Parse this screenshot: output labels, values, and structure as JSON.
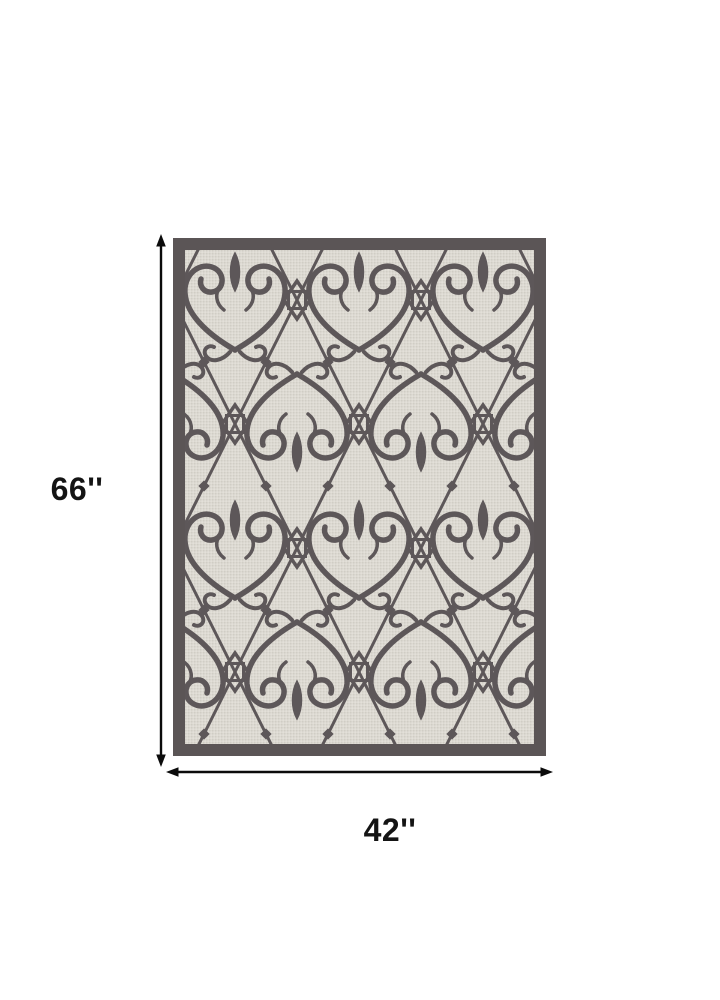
{
  "diagram": {
    "height_label": "66''",
    "width_label": "42''",
    "background_color": "#ffffff",
    "arrow_color": "#0b0b0b",
    "rug": {
      "border_color": "#5b5556",
      "field_color": "#dcd9d1",
      "field_fleck_dark": "#d0cdc5",
      "field_fleck_light": "#e5e2db",
      "pattern_color": "#5d5759",
      "pattern_name": "ornamental-ironwork-scrollwork"
    }
  }
}
